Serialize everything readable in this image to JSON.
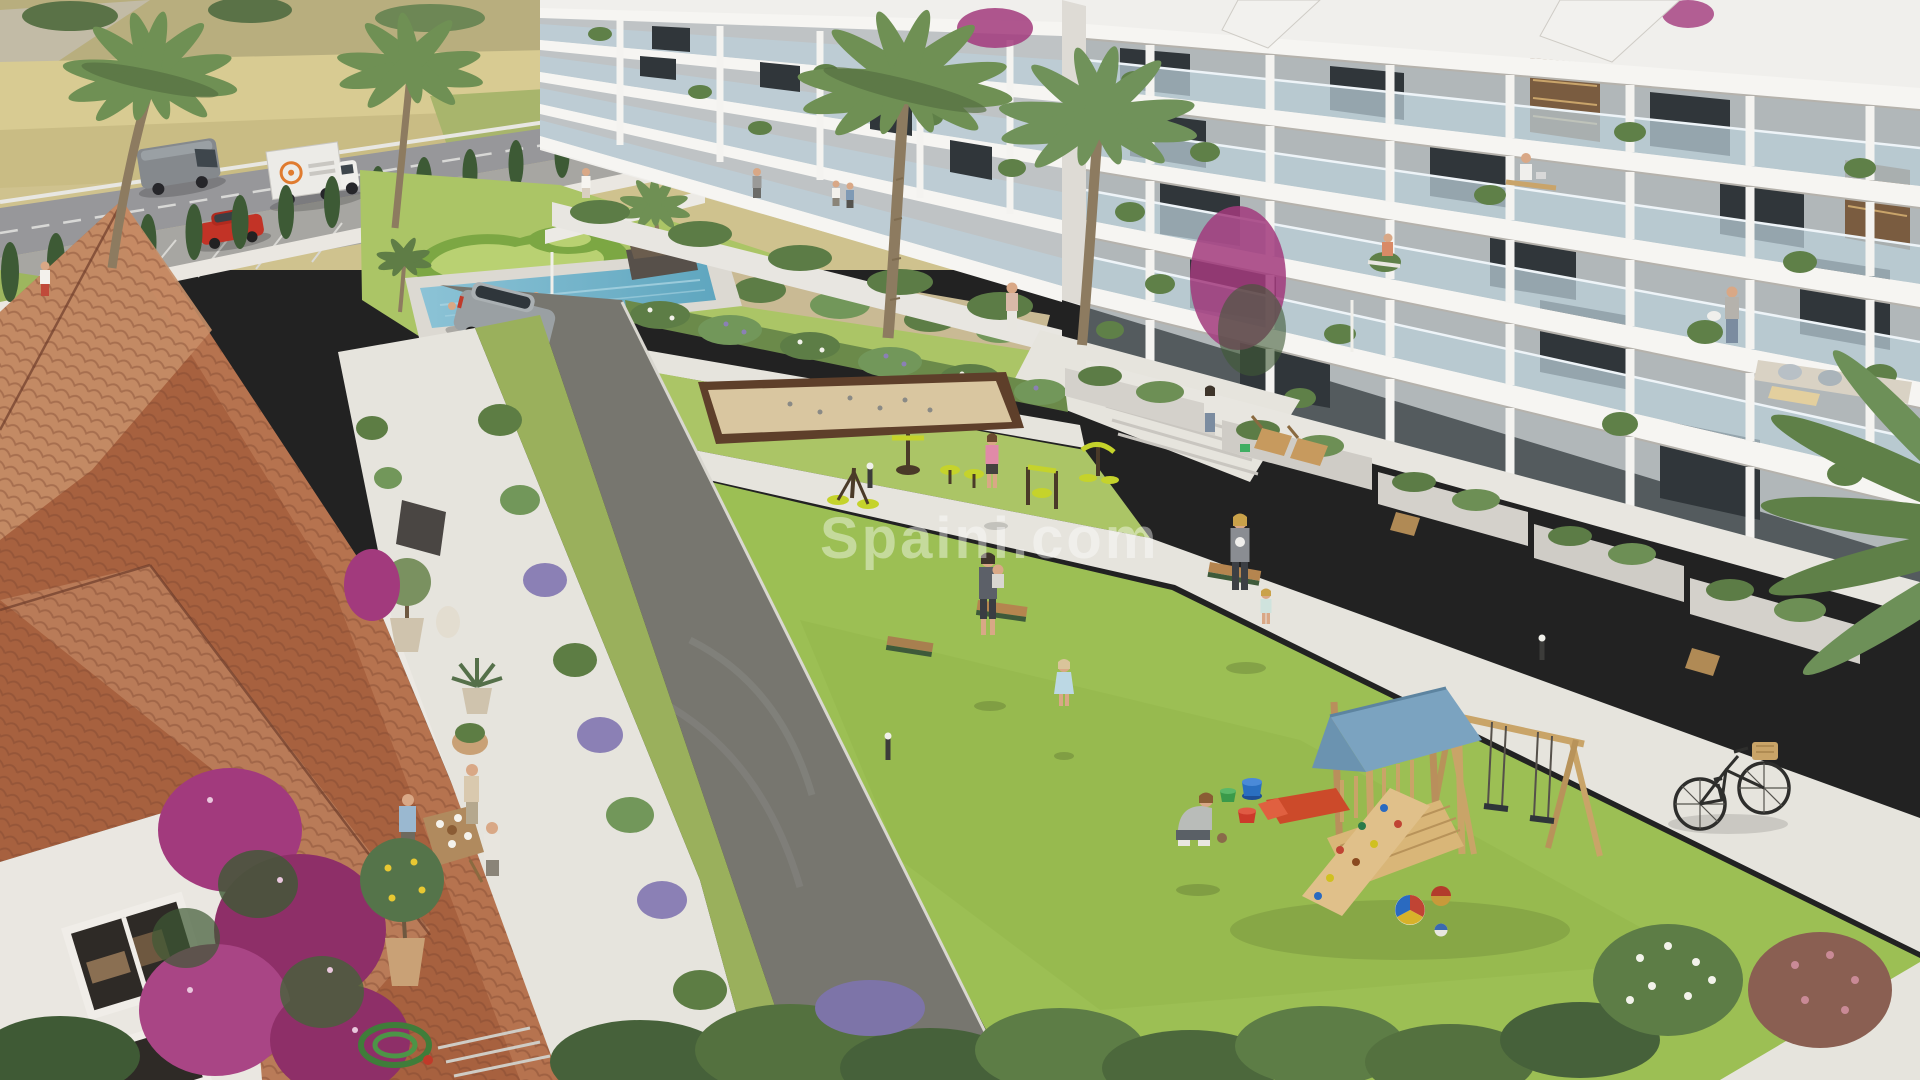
{
  "meta": {
    "kind": "architectural-render",
    "description": "Aerial 3D rendering of a modern residential complex: two white apartment wings with glass balconies, central lawn courtyard with playground and outdoor gym, swimming pool, pétanque court, terracotta-roofed clubhouse with dining terrace, farmland and access road beyond",
    "width_px": 1920,
    "height_px": 1080
  },
  "watermark": {
    "text": "Spaini.com",
    "color": "#ffffff",
    "opacity": 0.42
  },
  "palette": {
    "field_tan": "#cfc28e",
    "field_green": "#a8b56c",
    "road_gray": "#97979a",
    "parking_gray": "#a7a6a2",
    "cypress_green": "#3d5a35",
    "palm_green": "#6f9054",
    "palm_trunk": "#8d7b60",
    "lawn_light": "#abc566",
    "lawn_main": "#9cbf54",
    "hedge_green": "#7ca743",
    "pool_water": "#6fb3ca",
    "pool_deck": "#dcd9d2",
    "building_white": "#f0efec",
    "glass_blue": "#bcd0da",
    "window_dark": "#30363a",
    "roof_terracotta": "#a7613f",
    "roof_light": "#c78f68",
    "wall_white": "#eae7e1",
    "asphalt": "#77766f",
    "path_light": "#e6e4dd",
    "sand_court": "#d9c6a0",
    "court_border": "#5e3f2a",
    "gym_yellow": "#c5d32b",
    "bench_wood": "#b5854f",
    "play_wood": "#d9b678",
    "canopy_blue": "#7ba3c0",
    "slide_red": "#cc4a2a",
    "bougainvillea": "#a23a7d",
    "lavender": "#8b80b5",
    "bush_dark": "#46613a"
  },
  "objects": [
    {
      "id": "farm-fields",
      "label": "Farmland fields with tree line"
    },
    {
      "id": "access-road",
      "label": "Access road"
    },
    {
      "id": "delivery-van",
      "label": "Gray delivery van"
    },
    {
      "id": "box-truck",
      "label": "White box truck with orange logo"
    },
    {
      "id": "red-car",
      "label": "Red parked car"
    },
    {
      "id": "parking-area",
      "label": "Parking bays"
    },
    {
      "id": "cypress-hedge",
      "label": "Cypress tree screen along perimeter wall"
    },
    {
      "id": "far-apartment-wing",
      "label": "Far white apartment wing with glass balconies"
    },
    {
      "id": "near-apartment-wing",
      "label": "Near white apartment wing with glass balconies"
    },
    {
      "id": "swimming-pool",
      "label": "Lap pool with island planter palm"
    },
    {
      "id": "decorative-parterre",
      "label": "Sculpted hedge parterre lawn"
    },
    {
      "id": "petanque-court",
      "label": "Sand pétanque / boules court"
    },
    {
      "id": "outdoor-gym",
      "label": "Yellow outdoor gym equipment"
    },
    {
      "id": "main-lawn",
      "label": "Central courtyard lawn"
    },
    {
      "id": "driveway",
      "label": "Asphalt driveway with tyre marks"
    },
    {
      "id": "suv-car",
      "label": "Silver SUV on driveway"
    },
    {
      "id": "clubhouse-roof",
      "label": "Terracotta tiled roof of Spanish-style building"
    },
    {
      "id": "bougainvillea",
      "label": "Magenta bougainvillea on white wall"
    },
    {
      "id": "terrace-dining",
      "label": "People dining at terrace table"
    },
    {
      "id": "garden-hose",
      "label": "Coiled green garden hose"
    },
    {
      "id": "playground",
      "label": "Wooden play tower with blue canopy, red slide, climbing wall and swings"
    },
    {
      "id": "toy-buckets",
      "label": "Toy buckets and balls on grass"
    },
    {
      "id": "bicycle",
      "label": "Bicycle with basket on walkway"
    },
    {
      "id": "park-bench",
      "label": "Wooden park benches"
    },
    {
      "id": "palm-tree",
      "label": "Palm trees"
    },
    {
      "id": "people",
      "label": "Residents: walkers, parent with toddler, crouching boy, balcony man watering plants, man at desk, swimmers"
    }
  ]
}
